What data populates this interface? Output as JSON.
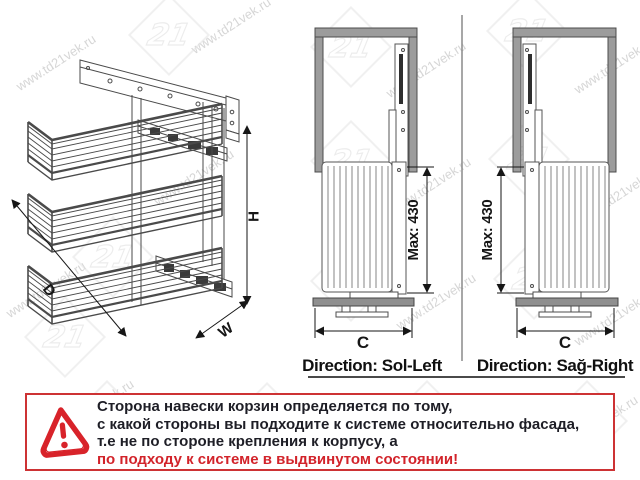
{
  "watermark": {
    "url_text": "www.td21vek.ru",
    "logo_text": "21"
  },
  "iso": {
    "depth_label": "D",
    "width_label": "W",
    "height_label": "H"
  },
  "views": {
    "left": {
      "max_label": "Max: 430",
      "width_label": "C",
      "direction_label": "Direction: Sol-Left"
    },
    "right": {
      "max_label": "Max: 430",
      "width_label": "C",
      "direction_label": "Direction: Sağ-Right"
    }
  },
  "warning": {
    "line1": "Сторона навески корзин определяется по тому,",
    "line2": "с какой стороны вы подходите к системе относительно фасада,",
    "line3": "т.е не по стороне крепления к корпусу, а",
    "line4": "по подходу к системе в выдвинутом состоянии!"
  },
  "colors": {
    "line": "#4a4a4a",
    "frame_fill": "#9c9c9c",
    "warning_border": "#cd3234",
    "warning_text": "#1e1e26",
    "warning_accent": "#d2232a",
    "watermark": "#cfcfcf"
  }
}
